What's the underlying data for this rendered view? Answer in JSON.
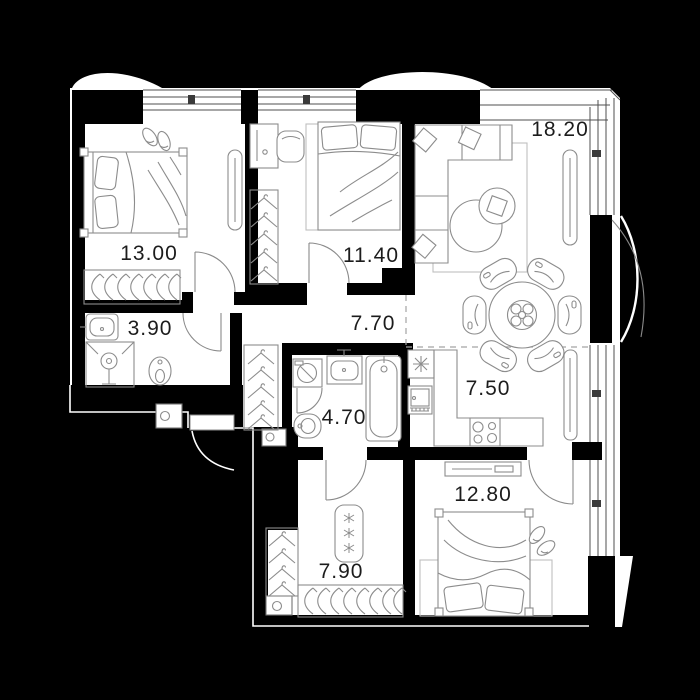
{
  "floorplan": {
    "background_color": "#000000",
    "floor_color": "#ffffff",
    "wall_color": "#000000",
    "furniture_line_color": "#8c8c8c",
    "label_color": "#1c1c1c",
    "rooms": [
      {
        "key": "living-room",
        "area": "18.20"
      },
      {
        "key": "bedroom-1",
        "area": "13.00"
      },
      {
        "key": "bedroom-2",
        "area": "11.40"
      },
      {
        "key": "bathroom-1",
        "area": "3.90"
      },
      {
        "key": "hallway",
        "area": "7.70"
      },
      {
        "key": "bathroom-2",
        "area": "4.70"
      },
      {
        "key": "kitchen",
        "area": "7.50"
      },
      {
        "key": "bedroom-3",
        "area": "12.80"
      },
      {
        "key": "wardrobe-room",
        "area": "7.90"
      }
    ]
  }
}
